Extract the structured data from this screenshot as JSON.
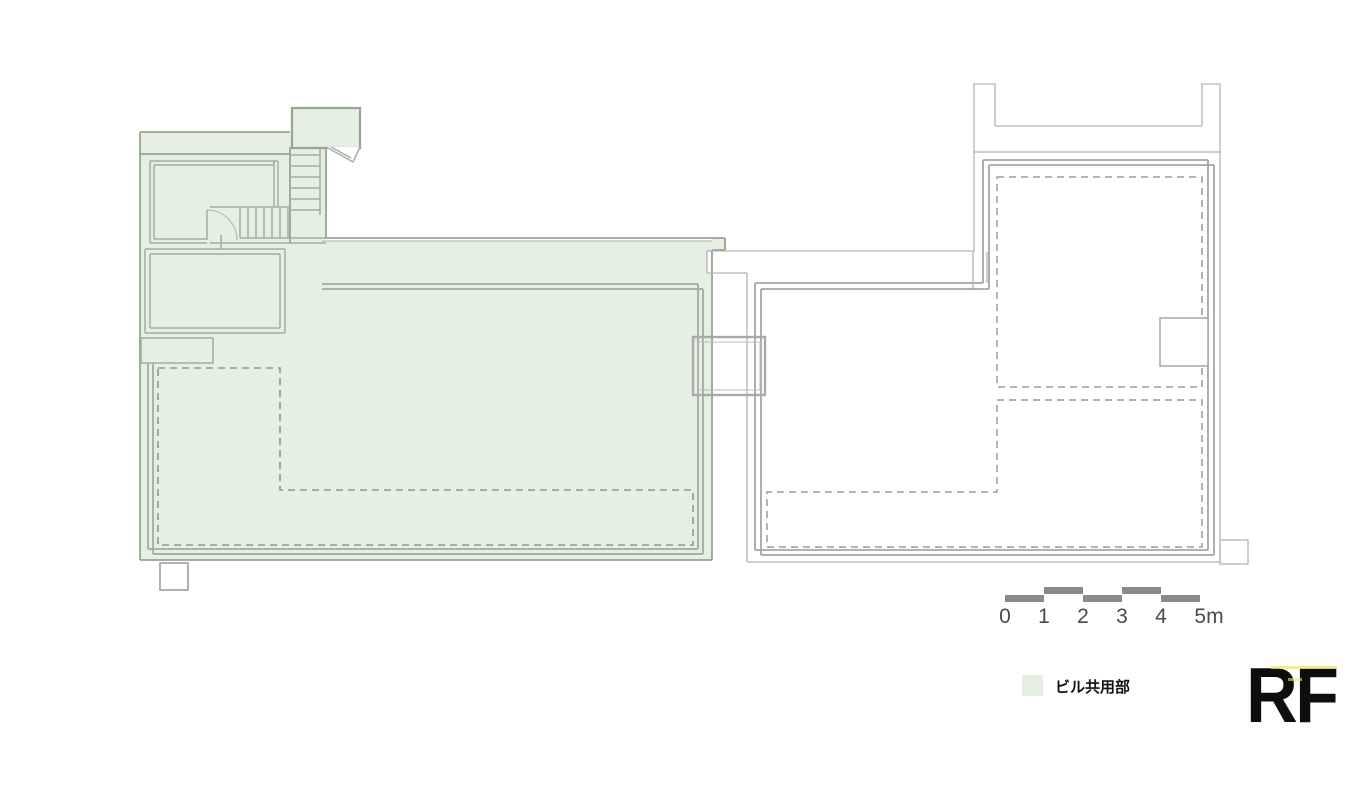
{
  "title": {
    "floor_label": "RF"
  },
  "legend": {
    "label": "ビル共用部",
    "swatch_color": "#e5efe2"
  },
  "scale_bar": {
    "labels": [
      "0",
      "1",
      "2",
      "3",
      "4",
      "5m"
    ],
    "bar_color": "#8a8a8a",
    "text_color": "#4a4a4a"
  },
  "colors": {
    "common_area_fill": "#e5efe2",
    "green_outer_wall": "#98a494",
    "green_inner_wall": "#a3ae9f",
    "green_terrace_border": "#a9b3a5",
    "green_dashed_line": "#8e998d",
    "gray_wall_thin": "#b3b3b3",
    "gray_wall_border": "#a6a6a6",
    "gray_dashed_line": "#9a9a9a",
    "bridge_outline": "#a9a9a9",
    "background": "#ffffff",
    "floor_label_color": "#0d0d0d"
  }
}
